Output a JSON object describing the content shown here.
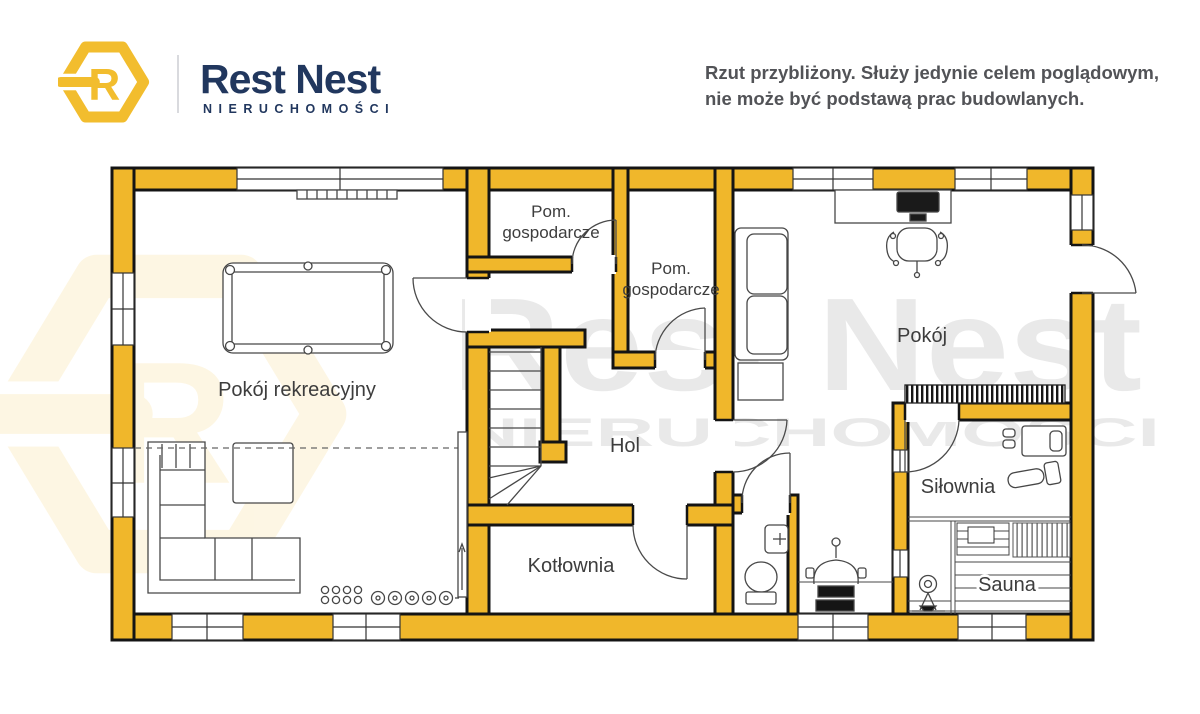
{
  "header": {
    "logo": {
      "letter": "R",
      "hex_color": "#F2BD2E"
    },
    "brand_name": "Rest Nest",
    "brand_subtitle": "NIERUCHOMOŚCI",
    "disclaimer": {
      "line1": "Rzut przybliżony. Służy jedynie celem poglądowym,",
      "line2": "nie może być podstawą prac budowlanych."
    }
  },
  "floorplan": {
    "wall_color": "#F0B72B",
    "outline_color": "#141414",
    "rooms": {
      "rekreacyjny": {
        "label": "Pokój rekreacyjny"
      },
      "gosp1": {
        "line1": "Pom.",
        "line2": "gospodarcze"
      },
      "gosp2": {
        "line1": "Pom.",
        "line2": "gospodarcze"
      },
      "hol": {
        "label": "Hol"
      },
      "pokoj": {
        "label": "Pokój"
      },
      "kotlownia": {
        "label": "Kotłownia"
      },
      "silownia": {
        "label": "Siłownia"
      },
      "sauna": {
        "label": "Sauna"
      }
    }
  },
  "watermark": {
    "primary": "Rest Nest",
    "secondary": "NIERUCHOMOŚCI",
    "logo_letter": "R"
  }
}
